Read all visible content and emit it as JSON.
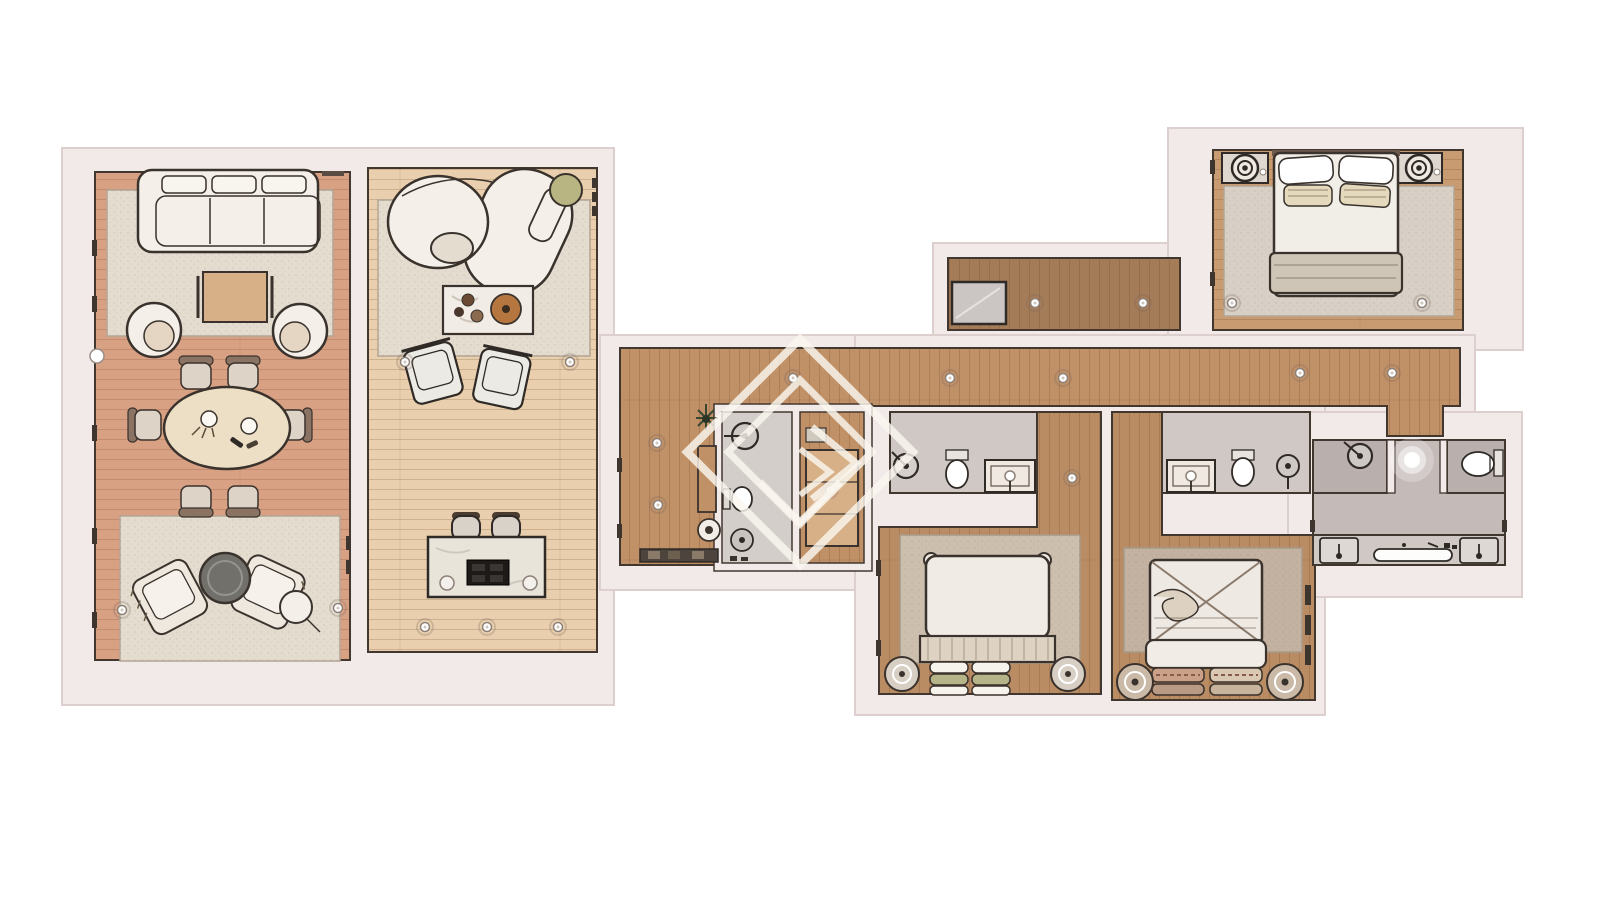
{
  "meta": {
    "kind": "rendered-floor-plan",
    "view": "top-down",
    "text_labels": []
  },
  "colors": {
    "background": "#ffffff",
    "wall": "#f2eae9",
    "wallEdge": "#dccfcd",
    "line": "#42372f",
    "livingFloor": "#d9a184",
    "familyFloor": "#e9cfad",
    "hallFloor": "#c09167",
    "upperCorridorFloor": "#a57c58",
    "bedroom1Floor": "#c89b71",
    "bedroomFloor": "#b98c64",
    "bathFloor": "#d0c8c5",
    "bathFloorDark": "#b9afac",
    "hallBathFloor": "#d4cecb",
    "masterBathFloor": "#c4bab7",
    "vanityCounter": "#cfc8c4",
    "rugLight": "#e3dccf",
    "rugWarm": "#cdbfae",
    "rugGray": "#c3b2a1",
    "rugBedroom1": "#d8d0c6",
    "furniture": "#f4efe9",
    "woodFurniture": "#d8b088",
    "tableTop": "#ecdfc6",
    "island": "#e9e4da",
    "cooktop": "#1d1a18",
    "ottoman": "#71706b",
    "pouf": "#b8b582",
    "pillowGreen": "#b5b388",
    "duvet": "#cfc5b6",
    "headboard": "#ded3c2",
    "cabinet": "#cbc6c4",
    "watermark": "#faf6ef"
  },
  "rooms": [
    {
      "id": "living-room",
      "label": "Living room",
      "furniture": [
        "three-seat sofa",
        "square coffee table",
        "two round lounge chairs",
        "oval dining table",
        "six dining chairs",
        "two lounge armchairs",
        "round ottoman",
        "round side table",
        "two area rugs"
      ]
    },
    {
      "id": "family-room",
      "label": "Family room with kitchen",
      "furniture": [
        "curved sofa",
        "green round pouf",
        "coffee table with trays",
        "two armchairs",
        "kitchen island with cooktop",
        "two bar stools",
        "area rug"
      ]
    },
    {
      "id": "entry-hall",
      "label": "Entry hall",
      "furniture": [
        "bench with shoes",
        "console table",
        "potted plant",
        "round side table",
        "guest WC with toilet, basin and shower head",
        "wardrobe"
      ]
    },
    {
      "id": "corridor",
      "label": "Corridor",
      "furniture": []
    },
    {
      "id": "upper-corridor",
      "label": "Upper corridor",
      "furniture": [
        "storage cabinet"
      ]
    },
    {
      "id": "bedroom-1",
      "label": "Main bedroom",
      "furniture": [
        "double bed with pillows and duvet",
        "two nightstands with round lamps",
        "large area rug"
      ]
    },
    {
      "id": "bathroom-1",
      "label": "Bathroom 1",
      "furniture": [
        "shower head",
        "toilet",
        "vanity with lamp"
      ]
    },
    {
      "id": "bedroom-2",
      "label": "Bedroom 2",
      "furniture": [
        "double bed with stacked pillows",
        "two round nightstands",
        "area rug"
      ]
    },
    {
      "id": "bathroom-2",
      "label": "Bathroom 2",
      "furniture": [
        "vanity with lamp",
        "toilet",
        "pedestal basin"
      ]
    },
    {
      "id": "bedroom-3",
      "label": "Bedroom 3",
      "furniture": [
        "double bed with cross-pattern duvet",
        "two round nightstands",
        "area rug",
        "wardrobe rail"
      ]
    },
    {
      "id": "master-bathroom",
      "label": "Master bathroom",
      "furniture": [
        "walk-in shower",
        "WC nook",
        "two vanity basins",
        "long bath trough",
        "ceiling light"
      ]
    }
  ],
  "watermark": {
    "description": "nested diamond logo watermark with chevron mark"
  }
}
